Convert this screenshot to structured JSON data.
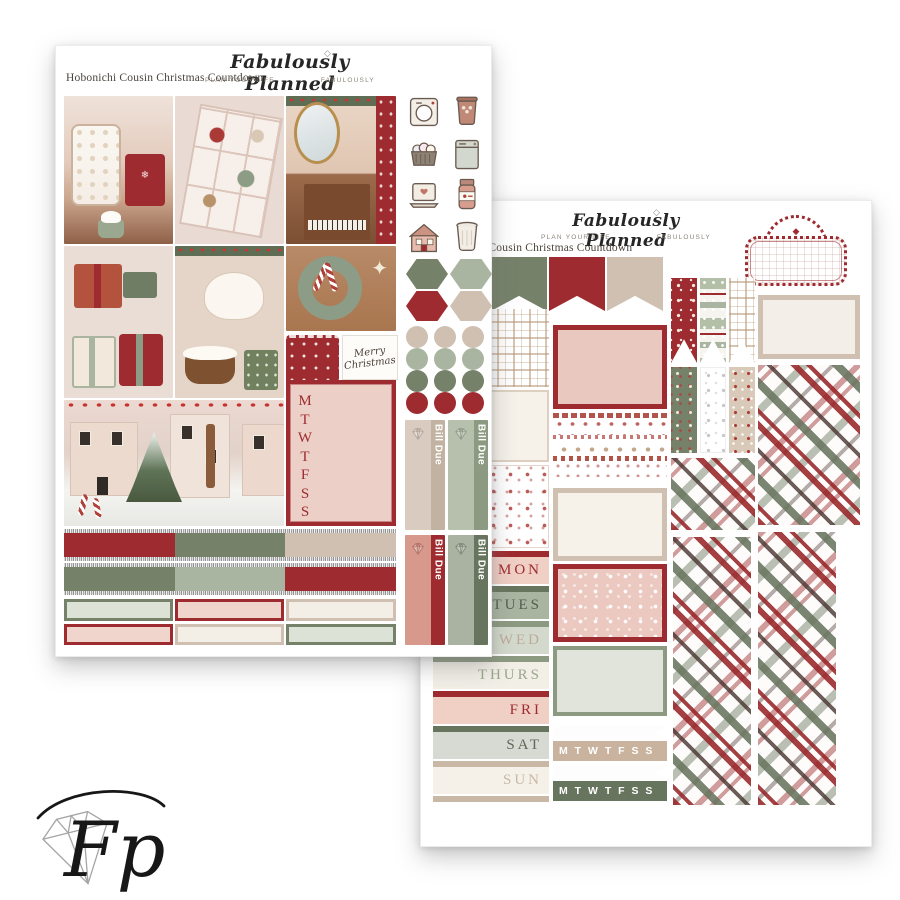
{
  "palette": {
    "red": "#9e2b2f",
    "dark_sage": "#76816a",
    "sage": "#a9b5a0",
    "beige": "#cfc0b2",
    "cream": "#f3efe7",
    "blush": "#ecd0c8",
    "silver": "#bdbdbd"
  },
  "brand": {
    "script": "Fabulously Planned",
    "tagline_left": "PLAN YOUR LIFE",
    "tagline_right": "FABULOUSLY",
    "watermark_initials": "Fp"
  },
  "glyphs": {
    "diamond": "◇",
    "marquee_diamond": "◆",
    "star": "✦",
    "snowflake": "❄"
  },
  "left_sheet": {
    "title": "Hobonichi Cousin Christmas Countdown",
    "weekday_letters": [
      "M",
      "T",
      "W",
      "T",
      "F",
      "S",
      "S"
    ],
    "merry_sticker": {
      "line1": "Merry",
      "line2": "Christmas"
    },
    "bill_due_label": "Bill Due",
    "photo_names": [
      "cookie-jar-and-cocoa",
      "christmas-candy-box",
      "christmas-piano",
      "christmas-presents",
      "pudding-and-teapot",
      "wreath-mug-candy-canes",
      "snowy-christmas-street"
    ],
    "icon_names": [
      "washing-machine",
      "trash-can",
      "laundry-basket",
      "dishwasher",
      "laptop",
      "medicine-bottle",
      "house",
      "trash-bin"
    ],
    "hexagon_colors": [
      "#76816a",
      "#a9b5a0",
      "#9e2b2f",
      "#cfc0b2"
    ],
    "circle_colors": [
      "#cfc0b2",
      "#cfc0b2",
      "#cfc0b2",
      "#a9b5a0",
      "#a9b5a0",
      "#a9b5a0",
      "#76816a",
      "#76816a",
      "#76816a",
      "#9e2b2f",
      "#9e2b2f",
      "#9e2b2f"
    ],
    "washi_rows": [
      [
        "#9e2b2f",
        "#76816a",
        "#cfc0b2"
      ],
      [
        "#76816a",
        "#a9b5a0",
        "#9e2b2f"
      ]
    ],
    "label_boxes": [
      {
        "bg": "#dde2d7",
        "border": "#76816a"
      },
      {
        "bg": "#f0d5cc",
        "border": "#9e2b2f"
      },
      {
        "bg": "#f3efe7",
        "border": "#cfc0b2"
      },
      {
        "bg": "#f0d5cc",
        "border": "#9e2b2f"
      },
      {
        "bg": "#f3efe7",
        "border": "#cfc0b2"
      },
      {
        "bg": "#dde2d7",
        "border": "#76816a"
      }
    ],
    "bill_due_variants": [
      {
        "body": "#d9cbbf",
        "band": "#c2b2a2"
      },
      {
        "body": "#b7c0ad",
        "band": "#8d9a82"
      },
      {
        "body": "#d6998b",
        "band": "#9e2b2f"
      },
      {
        "body": "#aab3a2",
        "band": "#68755e"
      }
    ]
  },
  "right_sheet": {
    "title": "Hobonichi Cousin Christmas Countdown",
    "flag_colors": [
      "#a9b5a0",
      "#76816a",
      "#9e2b2f",
      "#cfc0b2"
    ],
    "date_labels": [
      {
        "label": "MON",
        "band": "#9e2b2f",
        "bg": "#f0cfc5",
        "color": "#9e2b2f"
      },
      {
        "label": "TUES",
        "band": "#68755e",
        "bg": "#a9b5a0",
        "color": "#515e4c"
      },
      {
        "label": "WED",
        "band": "#8d9a82",
        "bg": "#d3d9cc",
        "color": "#bcab99"
      },
      {
        "label": "THURS",
        "band": "#8d9a82",
        "bg": "#f2efe7",
        "color": "#9aa68e"
      },
      {
        "label": "FRI",
        "band": "#9e2b2f",
        "bg": "#f0cfc5",
        "color": "#9e2b2f"
      },
      {
        "label": "SAT",
        "band": "#68755e",
        "bg": "#d7dad2",
        "color": "#5d6657"
      },
      {
        "label": "SUN",
        "band": "#c9b8a5",
        "bg": "#f5f1e9",
        "color": "#c9b8a5"
      }
    ],
    "sun_end_band": "#c9b8a5",
    "week_strips": [
      {
        "letters": "M T W T F S S",
        "color": "#c9b39e"
      },
      {
        "letters": "M T W T F S S",
        "color": "#68755e"
      }
    ]
  }
}
